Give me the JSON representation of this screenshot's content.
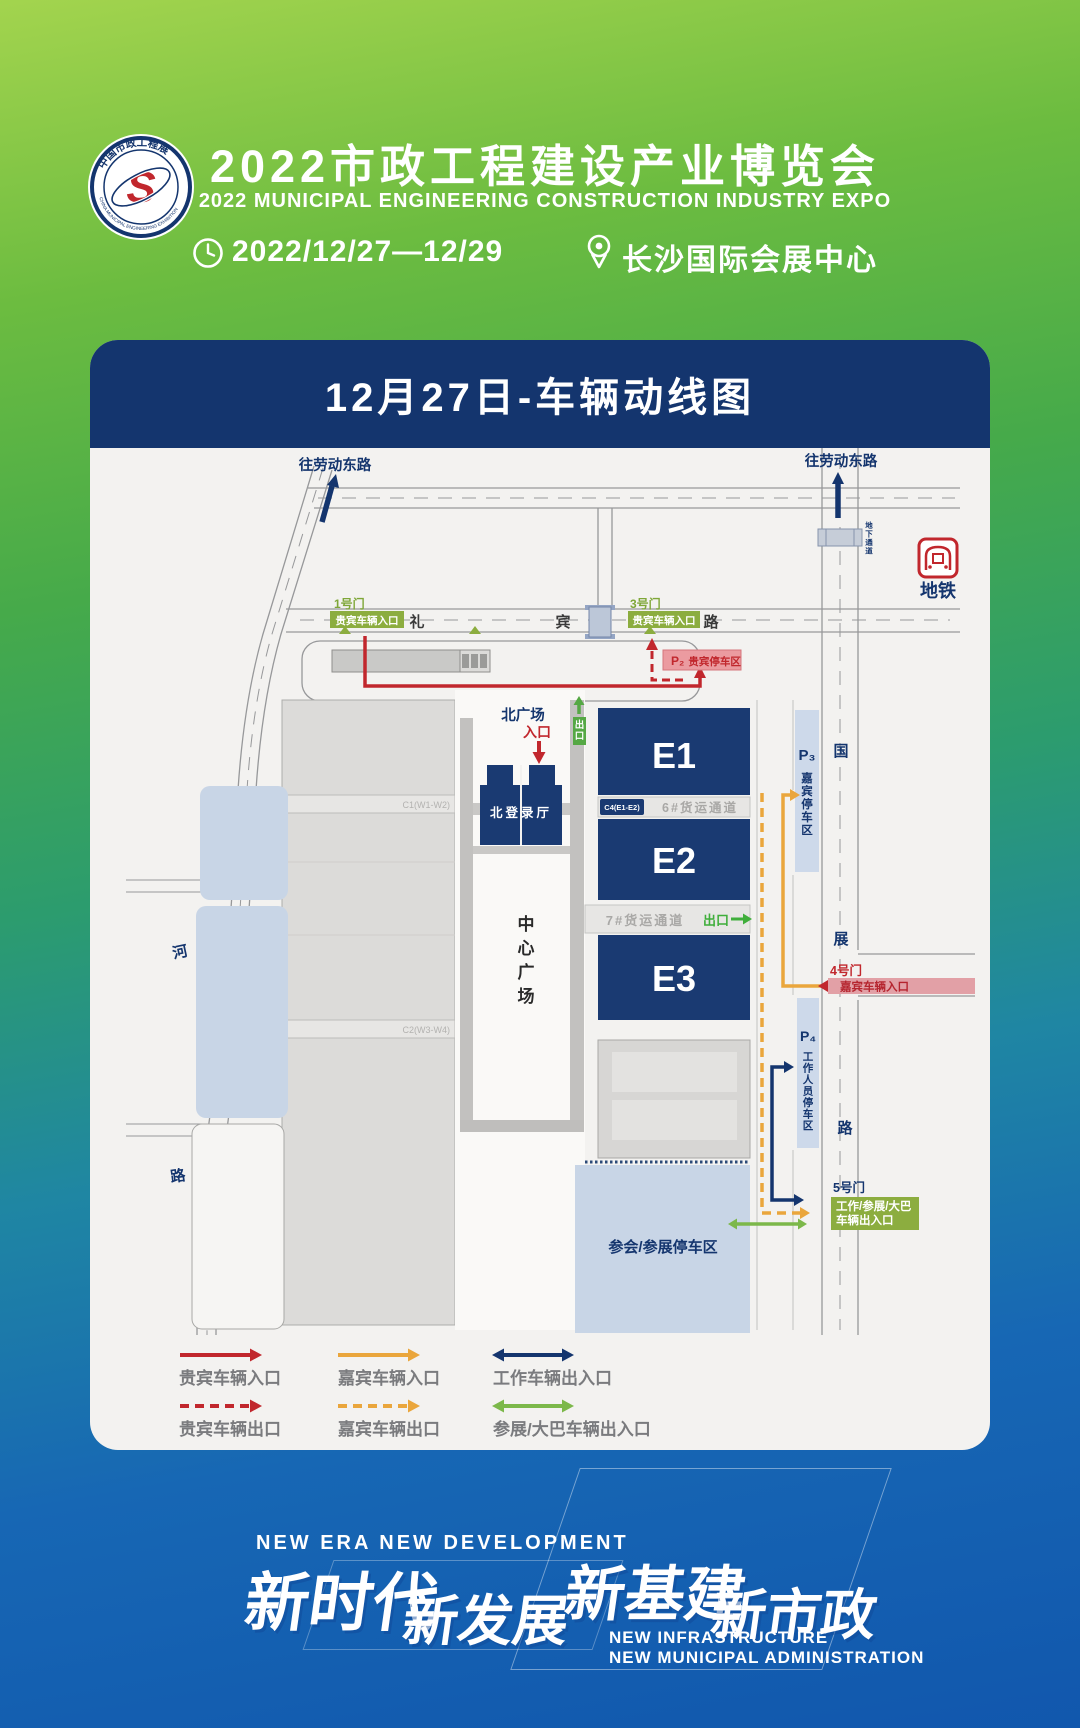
{
  "header": {
    "logo": {
      "ring_text_top": "中国市政工程展",
      "ring_text_bottom": "CHINA MUNICIPAL ENGINEERING EXHIBITION",
      "monogram": "S"
    },
    "title": "2022市政工程建设产业博览会",
    "subtitle": "2022 MUNICIPAL ENGINEERING CONSTRUCTION INDUSTRY EXPO",
    "date": "2022/12/27—12/29",
    "venue": "长沙国际会展中心"
  },
  "map_card": {
    "title": "12月27日-车辆动线图",
    "roads": {
      "libin": [
        "礼",
        "宾",
        "路"
      ],
      "guozhan": [
        "国",
        "展",
        "路"
      ],
      "west": [
        "河",
        "路"
      ],
      "to_laodong_left": "往劳动东路",
      "to_laodong_right": "往劳动东路",
      "underpass": "地下通道"
    },
    "metro": {
      "label": "地铁"
    },
    "gates": {
      "gate1": {
        "name": "1号门",
        "label": "贵宾车辆入口"
      },
      "gate3": {
        "name": "3号门",
        "label": "贵宾车辆入口"
      },
      "gate4": {
        "name": "4号门",
        "label": "嘉宾车辆入口"
      },
      "gate5": {
        "name": "5号门",
        "label_line1": "工作/参展/大巴",
        "label_line2": "车辆出入口"
      }
    },
    "halls": {
      "e1": "E1",
      "e2": "E2",
      "e3": "E3",
      "north_hall": "北登录厅",
      "west_c1": "C1(W1-W2)",
      "west_c2": "C2(W3-W4)",
      "c4": "C4(E1-E2)",
      "cargo6": "6#货运通道",
      "cargo7": "7#货运通道",
      "center_plaza": "中心广场"
    },
    "plaza": {
      "north_square": "北广场",
      "entrance": "入口",
      "exit_box": "出口",
      "cargo7_exit": "出口"
    },
    "parking": {
      "p2": {
        "id": "P₂",
        "label": "贵宾停车区"
      },
      "p3": {
        "id": "P₃",
        "label": "嘉宾停车区"
      },
      "p4": {
        "id": "P₄",
        "label": "工作人员停车区"
      },
      "south": "参会/参展停车区"
    },
    "legend": [
      {
        "label": "贵宾车辆入口",
        "color": "#c1272d",
        "style": "solid",
        "double": false
      },
      {
        "label": "嘉宾车辆入口",
        "color": "#eaa63c",
        "style": "solid",
        "double": false
      },
      {
        "label": "工作车辆出入口",
        "color": "#14356e",
        "style": "solid",
        "double": true
      },
      {
        "label": "贵宾车辆出口",
        "color": "#c1272d",
        "style": "dashed",
        "double": false
      },
      {
        "label": "嘉宾车辆出口",
        "color": "#eaa63c",
        "style": "dashed",
        "double": false
      },
      {
        "label": "参展/大巴车辆出入口",
        "color": "#7cb84a",
        "style": "solid",
        "double": true
      }
    ],
    "colors": {
      "navy": "#14356e",
      "hall_blue": "#1a3a72",
      "red": "#c1272d",
      "orange": "#eaa63c",
      "green_route": "#7cb84a",
      "gate_green": "#8cad3f",
      "parking_blue": "#c8d5e6",
      "vip_pink": "#eb9ba0"
    }
  },
  "footer": {
    "tagline_en": "NEW ERA  NEW DEVELOPMENT",
    "slogan1": "新时代",
    "slogan2": "新发展",
    "slogan3": "新基建",
    "slogan4": "新市政",
    "sub_en1": "NEW INFRASTRUCTURE",
    "sub_en2": "NEW MUNICIPAL ADMINISTRATION"
  }
}
